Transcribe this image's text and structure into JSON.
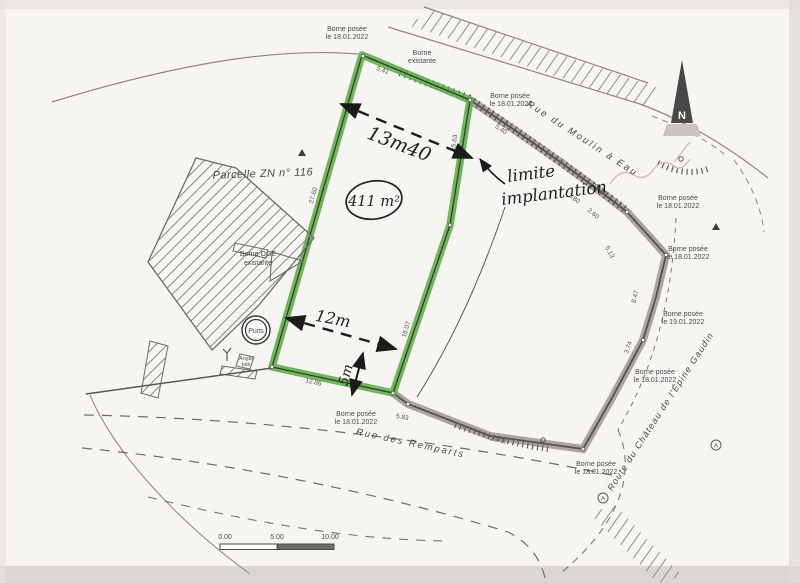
{
  "plan": {
    "parcel_label": "Parcelle ZN n° 116",
    "well": "Puits",
    "angle_line1": "Angle",
    "angle_line2": "bâti",
    "north_letter": "N",
    "marker_a": "A"
  },
  "streets": {
    "moulin_a_eau": "Rue du Moulin à Eau",
    "remparts": "Rue des Remparts",
    "chateau": "Route du Château de l'Épine Gaudin"
  },
  "bornes": {
    "posee_18_line1": "Borne posée",
    "posee_18_line2": "le 18.01.2022",
    "posee_19_line1": "Borne posée",
    "posee_19_line2": "le 19.01.2022",
    "existante_line1": "Borne",
    "existante_line2": "existante",
    "oge_line1": "Borne OGE",
    "oge_line2": "existante"
  },
  "handwritten": {
    "area": "411 m²",
    "dim_top": "13m40",
    "dim_mid": "12m",
    "dim_setback": "5m",
    "note_line1": "limite",
    "note_line2": "implantation"
  },
  "measurements": {
    "m1": "5.41",
    "m2": "5.40",
    "m3": "3.80",
    "m4": "2.60",
    "m5": "5.13",
    "m6": "8.47",
    "m7": "3.74",
    "m8": "5.83",
    "m9": "23.01",
    "m10": "12.86",
    "m11": "27.60",
    "m12": "15.63",
    "m13": "16.07"
  },
  "scale_bar": {
    "t0": "0.00",
    "t1": "5.00",
    "t2": "10.00"
  },
  "colors": {
    "highlight_green": "#5fae4a",
    "boundary_gray": "#a9a6a2",
    "ink": "#4b4a48"
  }
}
